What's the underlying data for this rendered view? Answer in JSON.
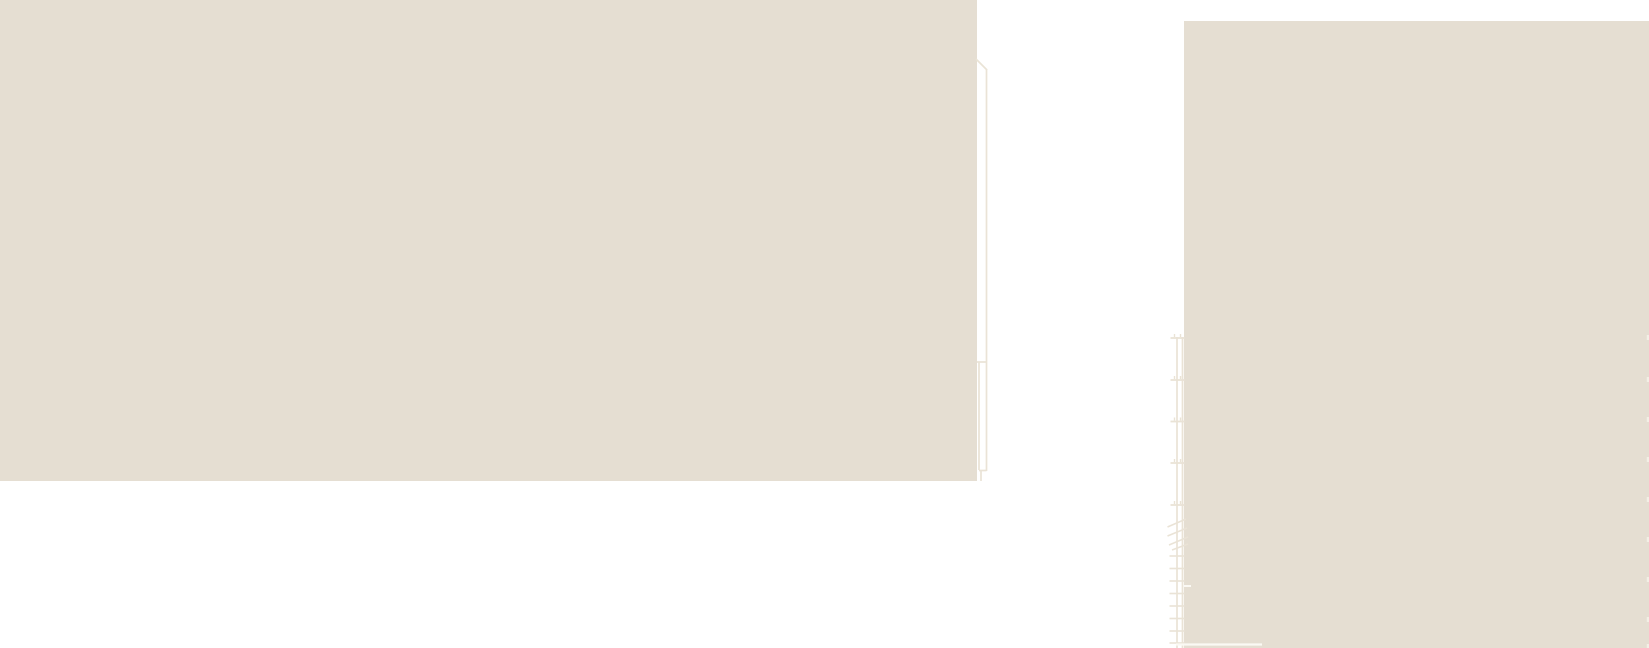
{
  "drawing": {
    "canvas": {
      "width": 1649,
      "height": 648,
      "background": "#ffffff"
    },
    "colors": {
      "mass_fill": "#e5ded2",
      "faint_line": "#eae3d6",
      "white_line": "#fbf9f4",
      "edge_tick": "#f3efe6"
    },
    "masses": [
      {
        "name": "left-building-mass",
        "x": 0,
        "y": 0,
        "width": 977,
        "height": 481
      },
      {
        "name": "right-building-mass",
        "x": 1184,
        "y": 21,
        "width": 465,
        "height": 627
      }
    ],
    "shaft_outline": {
      "diagonal": {
        "x1": 976,
        "y1": 59,
        "x2": 987,
        "y2": 70
      },
      "long_vertical": {
        "x1": 986.5,
        "y1": 69,
        "x2": 986.5,
        "y2": 471
      },
      "inner_vertical": {
        "x1": 979,
        "y1": 362,
        "x2": 979,
        "y2": 470
      },
      "top_cap": {
        "x1": 977,
        "y1": 362,
        "x2": 986,
        "y2": 362
      },
      "bottom_cap": {
        "x1": 979,
        "y1": 470.5,
        "x2": 986.5,
        "y2": 470.5
      },
      "tail_vertical": {
        "x1": 981,
        "y1": 471,
        "x2": 981,
        "y2": 481
      }
    },
    "ladder": {
      "rails": [
        {
          "x": 1177,
          "y1": 337,
          "y2": 648
        },
        {
          "x": 1182.5,
          "y1": 337,
          "y2": 648
        }
      ],
      "upper_rungs": {
        "x1": 1170.5,
        "x2": 1184.5,
        "ys": [
          338,
          380,
          421.5,
          463,
          505
        ]
      },
      "rung_tick_xs": [
        1174.5,
        1180.5
      ],
      "rung_tick_len": 4,
      "diagonals": [
        {
          "x1": 1167.5,
          "y1": 527,
          "x2": 1186,
          "y2": 519
        },
        {
          "x1": 1167.5,
          "y1": 536,
          "x2": 1187,
          "y2": 528
        },
        {
          "x1": 1169,
          "y1": 545,
          "x2": 1188,
          "y2": 537
        },
        {
          "x1": 1172,
          "y1": 550,
          "x2": 1188,
          "y2": 544
        }
      ],
      "lower_rungs": {
        "x1": 1169.5,
        "x2": 1184.5,
        "ys": [
          556,
          568.5,
          581,
          593.5,
          606,
          618.5,
          631,
          643
        ]
      }
    },
    "notches": {
      "bottom_line": {
        "x1": 1176,
        "y1": 644.5,
        "x2": 1262,
        "y2": 644.5
      },
      "side_notch": {
        "x1": 1184,
        "y1": 586,
        "x2": 1191,
        "y2": 586
      }
    },
    "edge_ticks": {
      "x": 1646.8,
      "width": 2.2,
      "tick_height": 5,
      "ys": [
        335,
        377,
        417,
        457,
        497,
        537,
        577,
        617,
        644
      ]
    }
  }
}
